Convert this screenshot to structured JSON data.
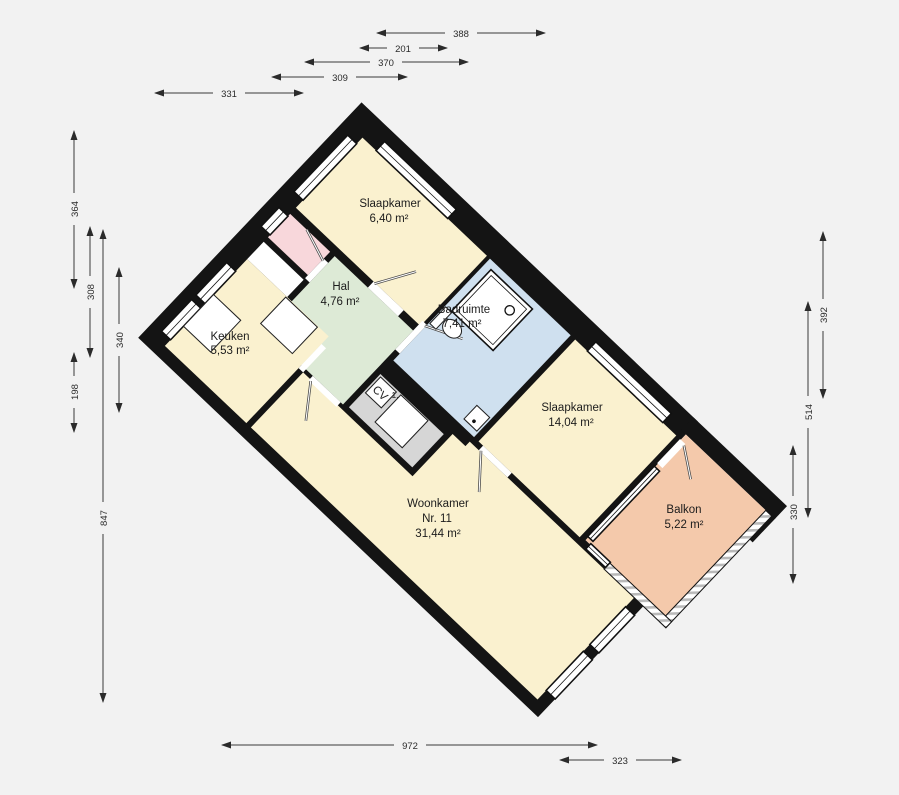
{
  "plan_title": "floorplan",
  "rooms": {
    "slaapkamer_1": {
      "name": "Slaapkamer",
      "area": "6,40 m²",
      "color": "#FAF1CF"
    },
    "hal": {
      "name": "Hal",
      "area": "4,76 m²",
      "color": "#DDEAD6"
    },
    "badruimte": {
      "name": "Badruimte",
      "area": "7,41 m²",
      "color": "#CFE0EF"
    },
    "keuken": {
      "name": "Keuken",
      "area": "5,53 m²",
      "color": "#FAF1CF"
    },
    "slaapkamer_2": {
      "name": "Slaapkamer",
      "area": "14,04 m²",
      "color": "#FAF1CF"
    },
    "woonkamer": {
      "name": "Woonkamer",
      "number": "Nr. 11",
      "area": "31,44 m²",
      "color": "#FAF1CF"
    },
    "balkon": {
      "name": "Balkon",
      "area": "5,22 m²",
      "color": "#F4C9AB"
    },
    "cv_kast": {
      "name": "CV",
      "area": "1,",
      "color": "#D6D6D6"
    },
    "berging": {
      "color": "#F8D7DB"
    },
    "entree": {
      "color": "#FFFFFF"
    }
  },
  "dimensions": {
    "top": [
      "388",
      "201",
      "370",
      "309",
      "331"
    ],
    "left": [
      "364",
      "308",
      "340",
      "198",
      "847"
    ],
    "right": [
      "392",
      "514",
      "330"
    ],
    "bottom": [
      "972",
      "323"
    ]
  },
  "colors": {
    "background": "#F2F2F2",
    "wall": "#141414",
    "dimension": "#3A3A3A"
  }
}
